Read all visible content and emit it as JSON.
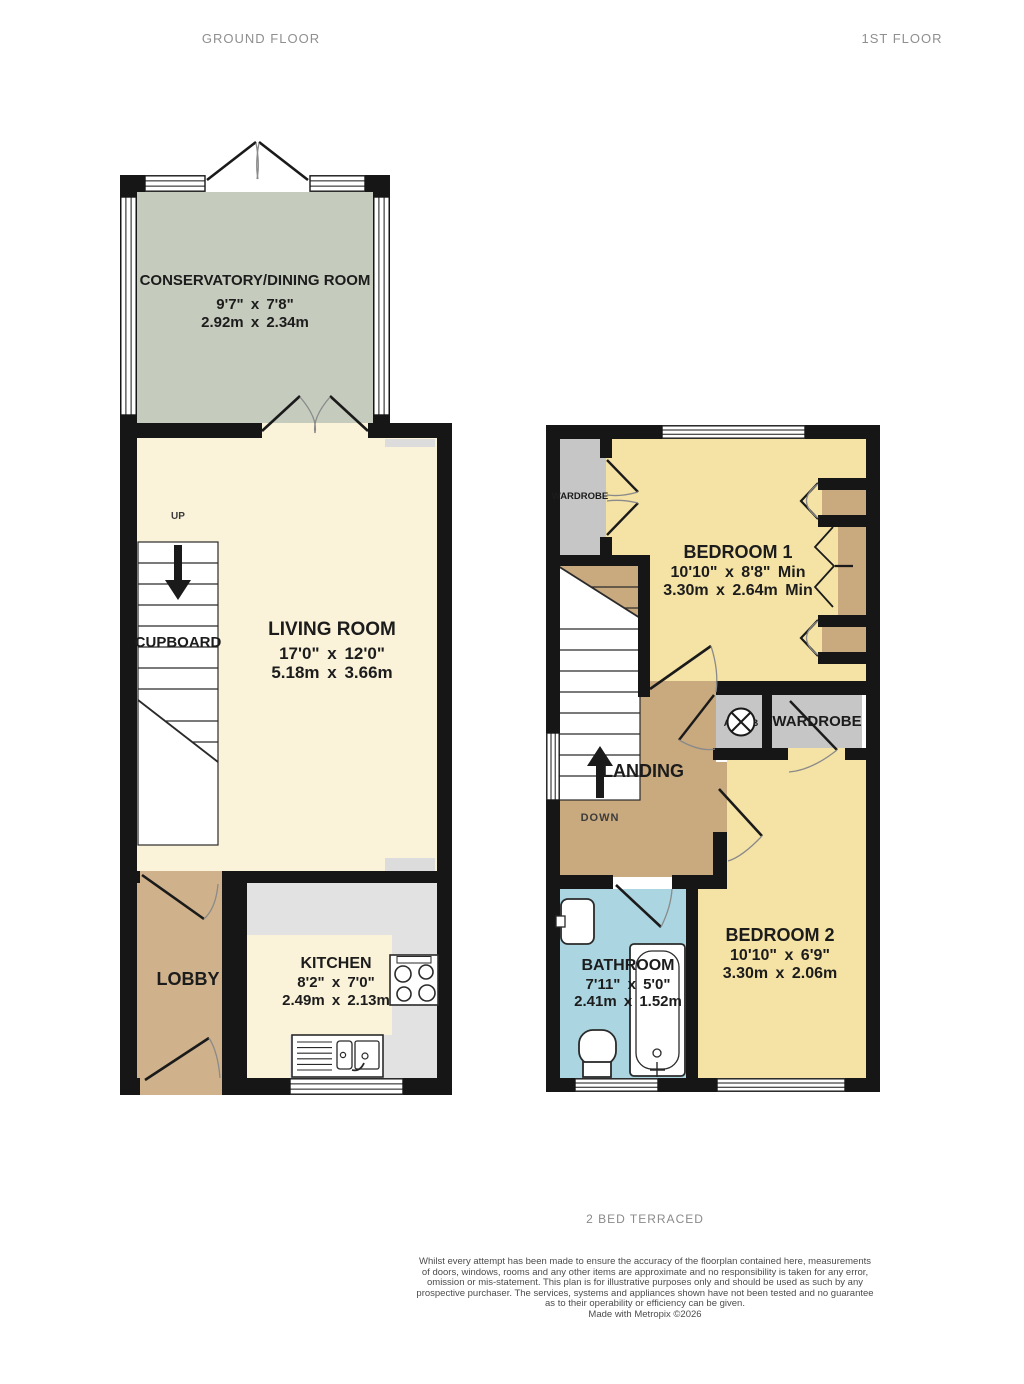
{
  "titles": {
    "ground": "GROUND FLOOR",
    "first": "1ST FLOOR"
  },
  "colors": {
    "conservatory": "#c5ccbe",
    "cream": "#faf3da",
    "bedroom": "#f5e3a6",
    "tan": "#c9a97e",
    "lobby": "#cfb28c",
    "bathroom": "#aad5e1",
    "counter": "#e2e2e2",
    "closet": "#c6c6c6",
    "wall": "#161616"
  },
  "rooms": {
    "conservatory": {
      "name": "CONSERVATORY/DINING ROOM",
      "imperial": "9'7\" x 7'8\"",
      "metric": "2.92m x 2.34m"
    },
    "living": {
      "name": "LIVING ROOM",
      "imperial": "17'0\" x 12'0\"",
      "metric": "5.18m x 3.66m"
    },
    "kitchen": {
      "name": "KITCHEN",
      "imperial": "8'2\" x 7'0\"",
      "metric": "2.49m x 2.13m"
    },
    "lobby": {
      "name": "LOBBY"
    },
    "bedroom1": {
      "name": "BEDROOM 1",
      "imperial": "10'10\" x 8'8\" Min",
      "metric": "3.30m x 2.64m Min"
    },
    "bedroom2": {
      "name": "BEDROOM 2",
      "imperial": "10'10\" x 6'9\"",
      "metric": "3.30m x 2.06m"
    },
    "bathroom": {
      "name": "BATHROOM",
      "imperial": "7'11\" x 5'0\"",
      "metric": "2.41m x 1.52m"
    },
    "landing": {
      "name": "LANDING"
    }
  },
  "labels": {
    "up": "UP",
    "down": "DOWN",
    "cupboard": "CUPBOARD",
    "wardrobe_bed1": "WARDROBE",
    "wardrobe_bed2": "WARDROBE",
    "airing_cupboard": "A/CUPB"
  },
  "footer": {
    "caption": "2 BED TERRACED",
    "disclaimer": [
      "Whilst every attempt has been made to ensure the accuracy of the floorplan contained here, measurements",
      "of doors, windows, rooms and any other items are approximate and no responsibility is taken for any error,",
      "omission or mis-statement. This plan is for illustrative purposes only and should be used as such by any",
      "prospective purchaser. The services, systems and appliances shown have not been tested and no guarantee",
      "as to their operability or efficiency can be given."
    ],
    "credit": "Made with Metropix ©2026"
  }
}
